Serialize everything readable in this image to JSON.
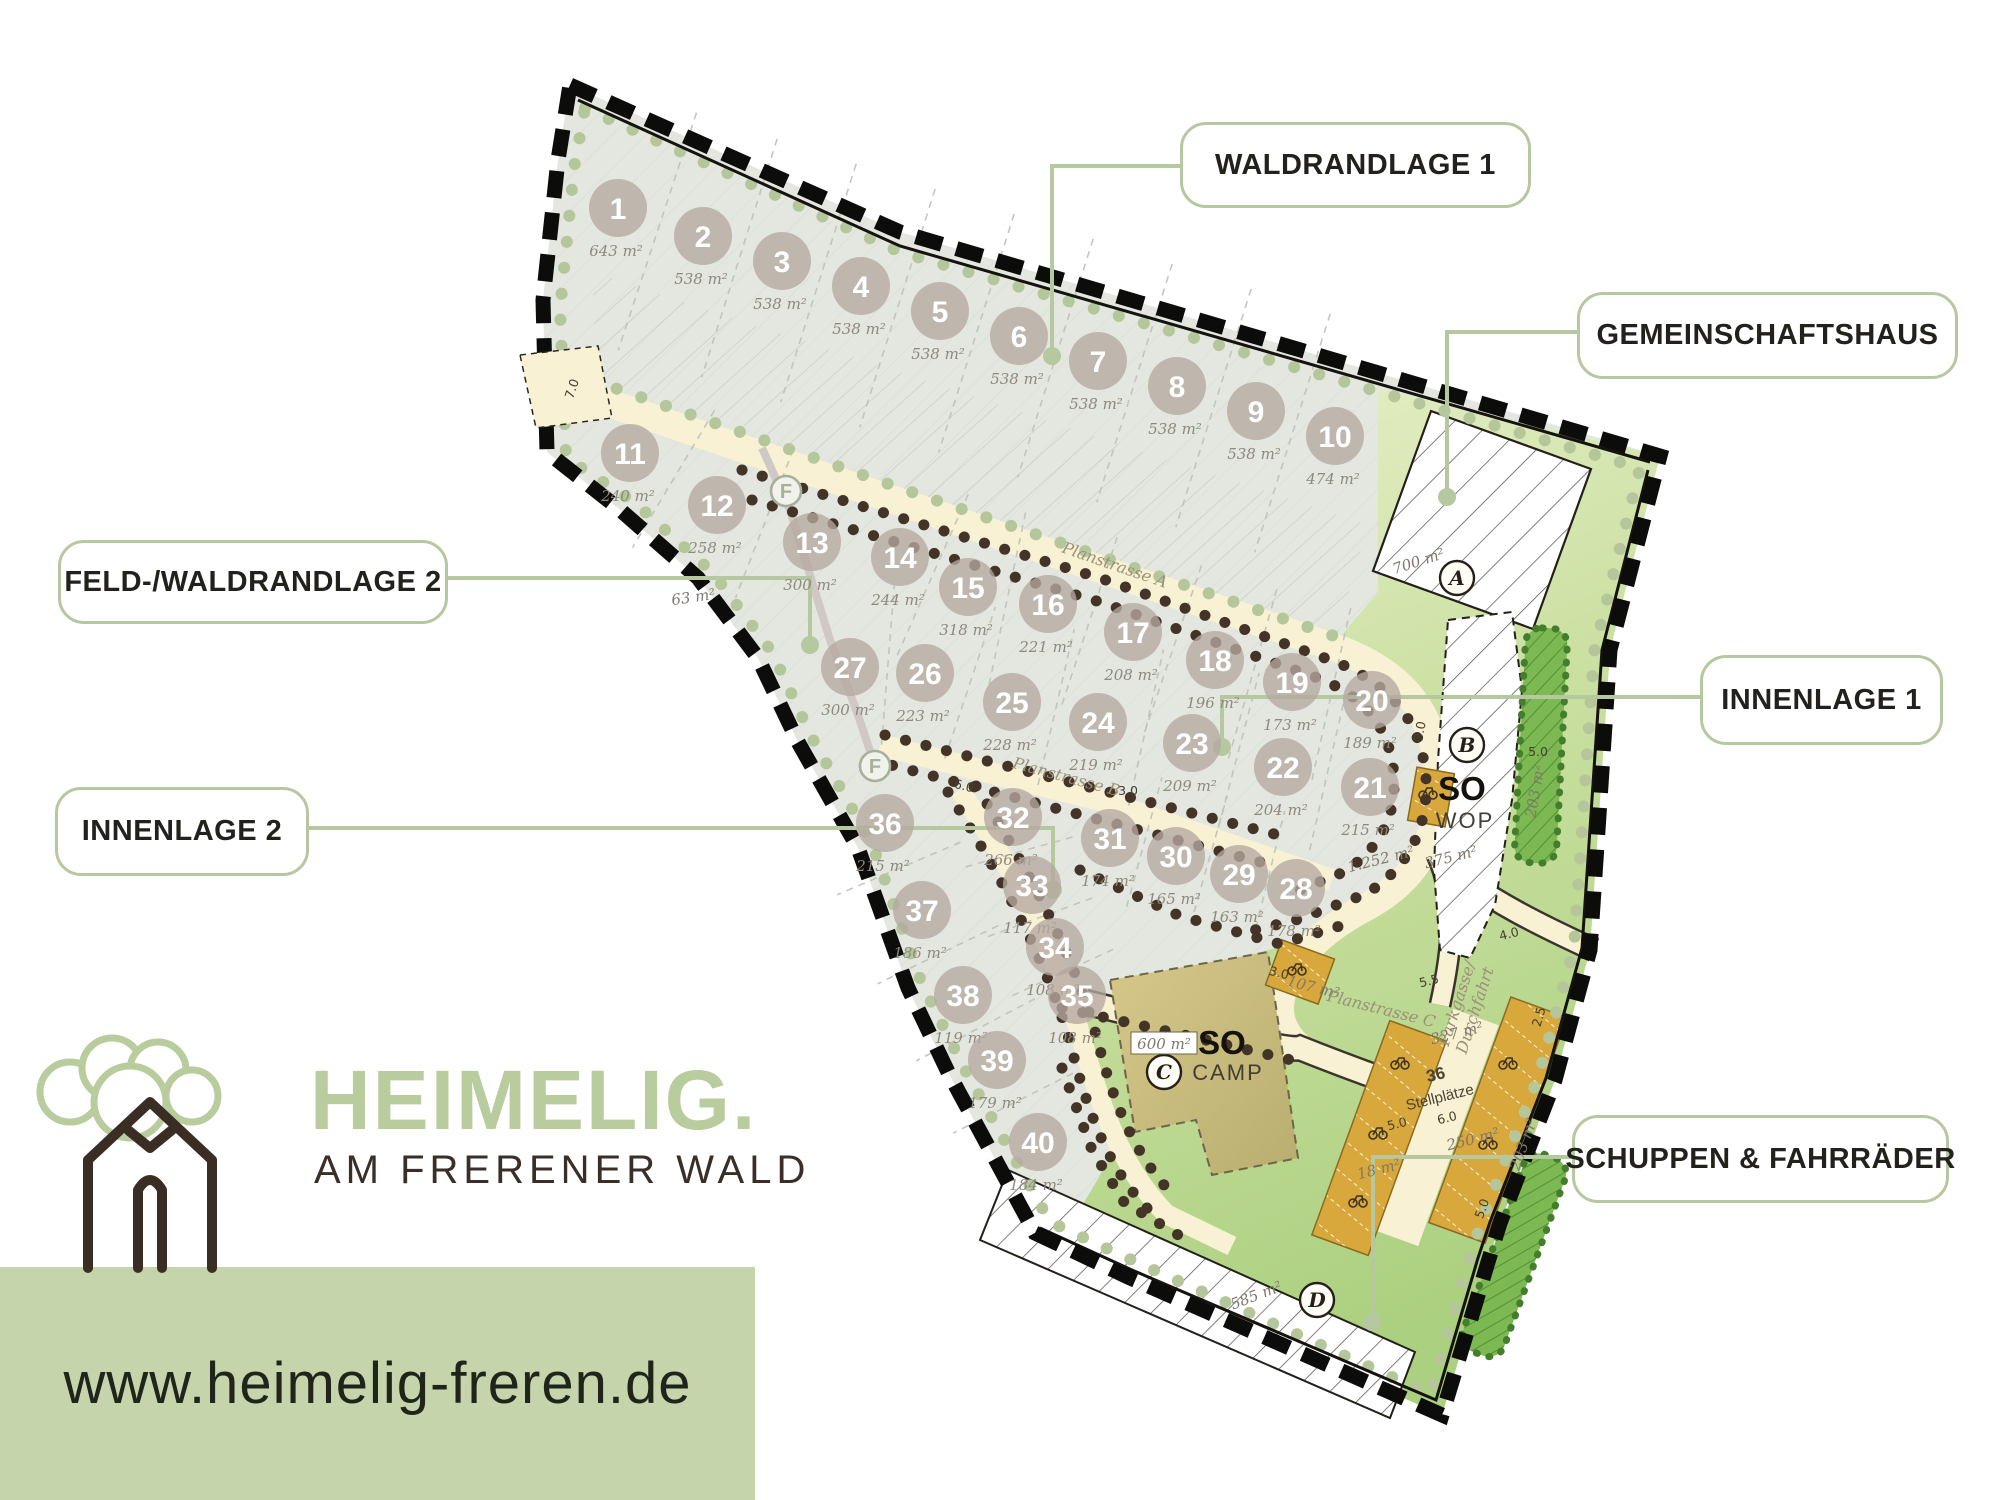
{
  "brand": {
    "name": "HEIMELIG.",
    "tagline": "AM FRERENER WALD",
    "website": "www.heimelig-freren.de",
    "green": "#b9cc9d",
    "brown": "#3a2f26"
  },
  "callouts": [
    {
      "id": "waldrandlage-1",
      "label": "WALDRANDLAGE 1"
    },
    {
      "id": "gemeinschaftshaus",
      "label": "GEMEINSCHAFTSHAUS"
    },
    {
      "id": "feld-waldrandlage-2",
      "label": "FELD-/WALDRANDLAGE 2"
    },
    {
      "id": "innenlage-1",
      "label": "INNENLAGE 1"
    },
    {
      "id": "innenlage-2",
      "label": "INNENLAGE 2"
    },
    {
      "id": "schuppen-fahrraeder",
      "label": "SCHUPPEN & FAHRRÄDER"
    }
  ],
  "map": {
    "plots": [
      {
        "n": "1",
        "a": "643 m²",
        "x": 618,
        "y": 208
      },
      {
        "n": "2",
        "a": "538 m²",
        "x": 703,
        "y": 236
      },
      {
        "n": "3",
        "a": "538 m²",
        "x": 782,
        "y": 261
      },
      {
        "n": "4",
        "a": "538 m²",
        "x": 861,
        "y": 286
      },
      {
        "n": "5",
        "a": "538 m²",
        "x": 940,
        "y": 311
      },
      {
        "n": "6",
        "a": "538 m²",
        "x": 1019,
        "y": 336
      },
      {
        "n": "7",
        "a": "538 m²",
        "x": 1098,
        "y": 361
      },
      {
        "n": "8",
        "a": "538 m²",
        "x": 1177,
        "y": 386
      },
      {
        "n": "9",
        "a": "538 m²",
        "x": 1256,
        "y": 411
      },
      {
        "n": "10",
        "a": "474 m²",
        "x": 1335,
        "y": 436
      },
      {
        "n": "11",
        "a": "240 m²",
        "x": 630,
        "y": 453
      },
      {
        "n": "12",
        "a": "258 m²",
        "x": 717,
        "y": 505
      },
      {
        "n": "13",
        "a": "300 m²",
        "x": 812,
        "y": 542
      },
      {
        "n": "14",
        "a": "244 m²",
        "x": 900,
        "y": 557
      },
      {
        "n": "15",
        "a": "318 m²",
        "x": 968,
        "y": 587
      },
      {
        "n": "16",
        "a": "221 m²",
        "x": 1048,
        "y": 604
      },
      {
        "n": "17",
        "a": "208 m²",
        "x": 1133,
        "y": 632
      },
      {
        "n": "18",
        "a": "196 m²",
        "x": 1215,
        "y": 660
      },
      {
        "n": "19",
        "a": "173 m²",
        "x": 1292,
        "y": 682
      },
      {
        "n": "20",
        "a": "189 m²",
        "x": 1372,
        "y": 700
      },
      {
        "n": "21",
        "a": "215 m²",
        "x": 1370,
        "y": 787
      },
      {
        "n": "22",
        "a": "204 m²",
        "x": 1283,
        "y": 767
      },
      {
        "n": "23",
        "a": "209 m²",
        "x": 1192,
        "y": 743
      },
      {
        "n": "24",
        "a": "219 m²",
        "x": 1098,
        "y": 722
      },
      {
        "n": "25",
        "a": "228 m²",
        "x": 1012,
        "y": 702
      },
      {
        "n": "26",
        "a": "223 m²",
        "x": 925,
        "y": 673
      },
      {
        "n": "27",
        "a": "300 m²",
        "x": 850,
        "y": 667
      },
      {
        "n": "28",
        "a": "178 m²",
        "x": 1296,
        "y": 888
      },
      {
        "n": "29",
        "a": "163 m²",
        "x": 1239,
        "y": 874
      },
      {
        "n": "30",
        "a": "165 m²",
        "x": 1176,
        "y": 856
      },
      {
        "n": "31",
        "a": "174 m²",
        "x": 1110,
        "y": 838
      },
      {
        "n": "32",
        "a": "266 m²",
        "x": 1013,
        "y": 817
      },
      {
        "n": "33",
        "a": "117 m²",
        "x": 1032,
        "y": 885
      },
      {
        "n": "34",
        "a": "108 m²",
        "x": 1055,
        "y": 947
      },
      {
        "n": "35",
        "a": "108 m²",
        "x": 1077,
        "y": 995
      },
      {
        "n": "36",
        "a": "215 m²",
        "x": 885,
        "y": 823
      },
      {
        "n": "37",
        "a": "186 m²",
        "x": 922,
        "y": 910
      },
      {
        "n": "38",
        "a": "119 m²",
        "x": 963,
        "y": 995
      },
      {
        "n": "39",
        "a": "179 m²",
        "x": 997,
        "y": 1060
      },
      {
        "n": "40",
        "a": "184 m²",
        "x": 1038,
        "y": 1142
      }
    ],
    "letter_markers": [
      {
        "l": "A",
        "x": 1457,
        "y": 578,
        "f": 0
      },
      {
        "l": "B",
        "x": 1467,
        "y": 745,
        "f": 0
      },
      {
        "l": "C",
        "x": 1164,
        "y": 1072,
        "f": 0
      },
      {
        "l": "D",
        "x": 1317,
        "y": 1300,
        "f": 0
      },
      {
        "l": "F",
        "x": 786,
        "y": 491,
        "f": 1
      },
      {
        "l": "F",
        "x": 875,
        "y": 766,
        "f": 1
      }
    ],
    "boxed_area": {
      "t": "600 m²",
      "x": 1164,
      "y": 1047
    },
    "annotations": [
      {
        "t": "Planstrasse A",
        "x": 1113,
        "y": 570,
        "r": 19,
        "c": "rd"
      },
      {
        "t": "Planstrasse B",
        "x": 1065,
        "y": 782,
        "r": 15,
        "c": "rd"
      },
      {
        "t": "107 m²",
        "x": 1312,
        "y": 992,
        "r": 14,
        "c": "ar"
      },
      {
        "t": "Planstrasse C",
        "x": 1380,
        "y": 1014,
        "r": 14,
        "c": "rd"
      },
      {
        "t": "Parkgasse/",
        "x": 1462,
        "y": 1005,
        "r": -72,
        "c": "rd"
      },
      {
        "t": "Durchfahrt",
        "x": 1480,
        "y": 1012,
        "r": -72,
        "c": "rd"
      },
      {
        "t": "700 m²",
        "x": 1420,
        "y": 566,
        "r": -18,
        "c": "ar"
      },
      {
        "t": "375 m²",
        "x": 1452,
        "y": 862,
        "r": -14,
        "c": "ar"
      },
      {
        "t": "1.252 m²",
        "x": 1382,
        "y": 864,
        "r": -14,
        "c": "ar"
      },
      {
        "t": "203 m²",
        "x": 1540,
        "y": 792,
        "r": -80,
        "c": "ar"
      },
      {
        "t": "203 m²",
        "x": 1528,
        "y": 1146,
        "r": -70,
        "c": "ar"
      },
      {
        "t": "585 m²",
        "x": 1258,
        "y": 1300,
        "r": -21,
        "c": "ar"
      },
      {
        "t": "327 m²",
        "x": 1458,
        "y": 1038,
        "r": -14,
        "c": "ar"
      },
      {
        "t": "250 m²",
        "x": 1474,
        "y": 1144,
        "r": -14,
        "c": "ar"
      },
      {
        "t": "18 m²",
        "x": 1380,
        "y": 1174,
        "r": -14,
        "c": "ar"
      },
      {
        "t": "63 m²",
        "x": 694,
        "y": 602,
        "r": -8,
        "c": "ar"
      },
      {
        "t": "7.0",
        "x": 576,
        "y": 390,
        "r": -72,
        "c": "dim"
      },
      {
        "t": "3.0",
        "x": 1424,
        "y": 732,
        "r": -80,
        "c": "dim"
      },
      {
        "t": "5.0",
        "x": 1538,
        "y": 756,
        "r": 0,
        "c": "dim"
      },
      {
        "t": "5.0",
        "x": 1398,
        "y": 1128,
        "r": -14,
        "c": "dim"
      },
      {
        "t": "6.0",
        "x": 1448,
        "y": 1122,
        "r": -14,
        "c": "dim"
      },
      {
        "t": "5.0",
        "x": 1486,
        "y": 1210,
        "r": -70,
        "c": "dim"
      },
      {
        "t": "2.5",
        "x": 1543,
        "y": 1018,
        "r": -74,
        "c": "dim"
      },
      {
        "t": "4.0",
        "x": 1510,
        "y": 938,
        "r": -14,
        "c": "dim"
      },
      {
        "t": "3.0",
        "x": 1278,
        "y": 977,
        "r": 14,
        "c": "dim"
      },
      {
        "t": "6.0",
        "x": 963,
        "y": 790,
        "r": 14,
        "c": "dim"
      },
      {
        "t": "3.0",
        "x": 1128,
        "y": 795,
        "r": 0,
        "c": "dim"
      },
      {
        "t": "5.5",
        "x": 1430,
        "y": 985,
        "r": -14,
        "c": "dim"
      },
      {
        "t": "36",
        "x": 1437,
        "y": 1080,
        "r": -14,
        "c": "pk"
      },
      {
        "t": "Stellplätze",
        "x": 1441,
        "y": 1102,
        "r": -14,
        "c": "pk2"
      },
      {
        "t": "SO",
        "x": 1462,
        "y": 800,
        "r": 0,
        "c": "so"
      },
      {
        "t": "WOP",
        "x": 1465,
        "y": 828,
        "r": 0,
        "c": "sub"
      },
      {
        "t": "SO",
        "x": 1222,
        "y": 1054,
        "r": 0,
        "c": "so"
      },
      {
        "t": "CAMP",
        "x": 1228,
        "y": 1080,
        "r": 0,
        "c": "sub"
      }
    ],
    "colors": {
      "plot_fill": "#e3e7e0",
      "road": "#f8f1d4",
      "green_zone": "#c4dd9b",
      "parking": "#d8a83c",
      "hedge": "#7cb952",
      "boundary": "#0c0c0a",
      "callout_border": "#b6c8a0"
    }
  }
}
